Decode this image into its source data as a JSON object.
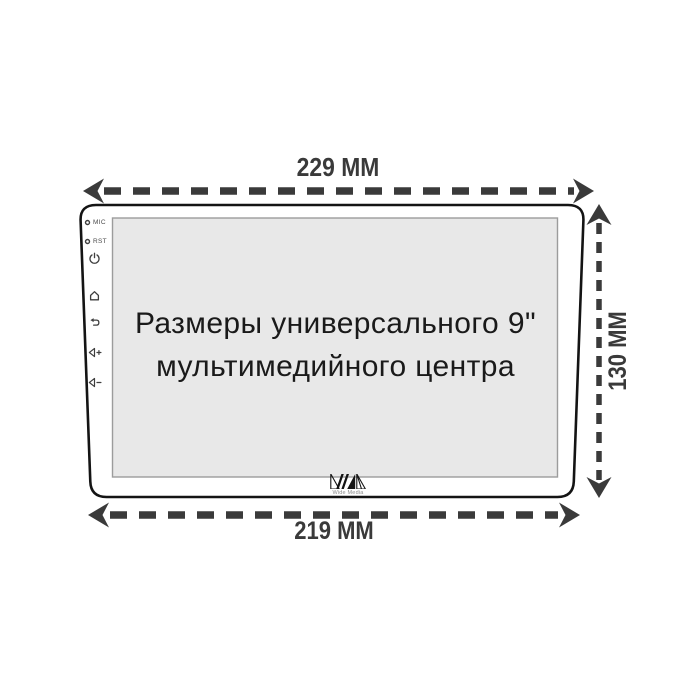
{
  "diagram": {
    "screen_text": {
      "line1": "Размеры универсального 9\"",
      "line2": "мультимедийного центра"
    },
    "dimensions": {
      "top_label": "229 ММ",
      "right_label": "130 ММ",
      "bottom_label": "219 ММ",
      "top_mm": 229,
      "right_mm": 130,
      "bottom_mm": 219,
      "unit": "ММ"
    },
    "side_panel": {
      "mic_label": "MIC",
      "rst_label": "RST",
      "icons": [
        "mic-hole-icon",
        "rst-hole-icon",
        "power-icon",
        "home-icon",
        "back-icon",
        "volume-up-icon",
        "volume-down-icon"
      ]
    },
    "logo": {
      "text": "Wide Media",
      "mark": "wm-diagonal-stripes"
    },
    "colors": {
      "dimension": "#3a3a3a",
      "outline": "#141414",
      "screen_fill": "#e8e8e8",
      "screen_border": "#9c9c9c",
      "background": "#ffffff"
    }
  }
}
